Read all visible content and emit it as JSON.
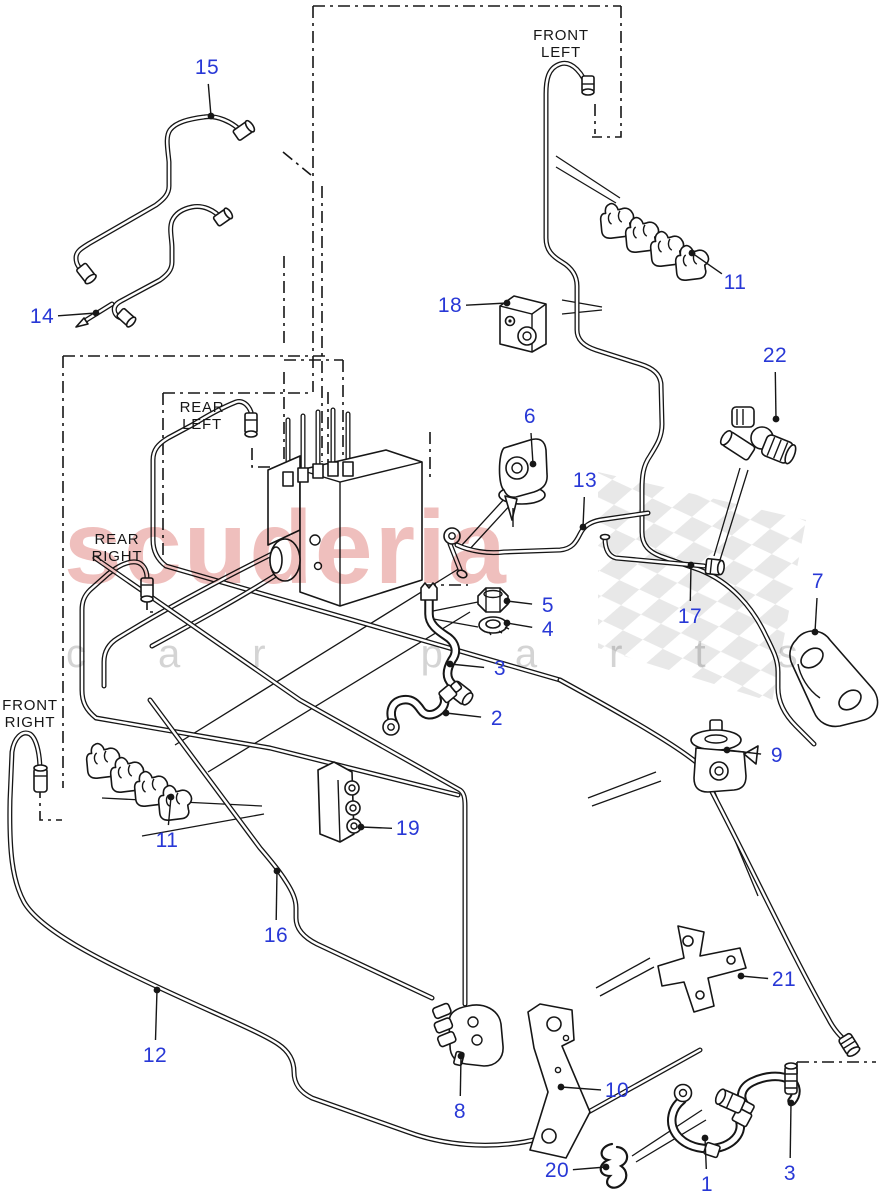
{
  "watermark": {
    "brand": "scuderia",
    "sub": "car parts",
    "brand_color": "#e0807b",
    "sub_color": "#c9c9c9"
  },
  "colors": {
    "callout": "#2838d6",
    "line": "#161616",
    "flag": "#d9d9d9"
  },
  "corner_labels": [
    {
      "id": "front-left",
      "line1": "FRONT",
      "line2": "LEFT",
      "x": 561,
      "y": 44
    },
    {
      "id": "rear-left",
      "line1": "REAR",
      "line2": "LEFT",
      "x": 202,
      "y": 416
    },
    {
      "id": "rear-right",
      "line1": "REAR",
      "line2": "RIGHT",
      "x": 117,
      "y": 548
    },
    {
      "id": "front-right",
      "line1": "FRONT",
      "line2": "RIGHT",
      "x": 30,
      "y": 714
    }
  ],
  "callouts": [
    {
      "id": "15",
      "label": "15",
      "x": 207,
      "y": 68,
      "dot": [
        211,
        116
      ]
    },
    {
      "id": "14",
      "label": "14",
      "x": 42,
      "y": 317,
      "dot": [
        96,
        313
      ]
    },
    {
      "id": "11-top",
      "label": "11",
      "x": 735,
      "y": 283,
      "dot": [
        692,
        253
      ]
    },
    {
      "id": "18",
      "label": "18",
      "x": 450,
      "y": 306,
      "dot": [
        507,
        303
      ]
    },
    {
      "id": "22",
      "label": "22",
      "x": 775,
      "y": 356,
      "dot": [
        776,
        419
      ]
    },
    {
      "id": "6",
      "label": "6",
      "x": 530,
      "y": 417,
      "dot": [
        533,
        464
      ]
    },
    {
      "id": "13",
      "label": "13",
      "x": 585,
      "y": 481,
      "dot": [
        583,
        527
      ]
    },
    {
      "id": "5",
      "label": "5",
      "x": 548,
      "y": 606,
      "dot": [
        507,
        601
      ]
    },
    {
      "id": "4",
      "label": "4",
      "x": 548,
      "y": 630,
      "dot": [
        507,
        623
      ]
    },
    {
      "id": "3-mid",
      "label": "3",
      "x": 500,
      "y": 669,
      "dot": [
        450,
        664
      ]
    },
    {
      "id": "2",
      "label": "2",
      "x": 497,
      "y": 719,
      "dot": [
        446,
        713
      ]
    },
    {
      "id": "17",
      "label": "17",
      "x": 690,
      "y": 617,
      "dot": [
        691,
        565
      ]
    },
    {
      "id": "7",
      "label": "7",
      "x": 818,
      "y": 582,
      "dot": [
        815,
        632
      ]
    },
    {
      "id": "11-left",
      "label": "11",
      "x": 167,
      "y": 841,
      "dot": [
        171,
        797
      ]
    },
    {
      "id": "19",
      "label": "19",
      "x": 408,
      "y": 829,
      "dot": [
        361,
        827
      ]
    },
    {
      "id": "9",
      "label": "9",
      "x": 777,
      "y": 756,
      "dot": [
        727,
        750
      ]
    },
    {
      "id": "16",
      "label": "16",
      "x": 276,
      "y": 936,
      "dot": [
        277,
        871
      ]
    },
    {
      "id": "21",
      "label": "21",
      "x": 784,
      "y": 980,
      "dot": [
        741,
        976
      ]
    },
    {
      "id": "12",
      "label": "12",
      "x": 155,
      "y": 1056,
      "dot": [
        157,
        990
      ]
    },
    {
      "id": "8",
      "label": "8",
      "x": 460,
      "y": 1112,
      "dot": [
        461,
        1056
      ]
    },
    {
      "id": "10",
      "label": "10",
      "x": 617,
      "y": 1091,
      "dot": [
        561,
        1087
      ]
    },
    {
      "id": "20",
      "label": "20",
      "x": 557,
      "y": 1171,
      "dot": [
        606,
        1167
      ]
    },
    {
      "id": "1",
      "label": "1",
      "x": 707,
      "y": 1185,
      "dot": [
        705,
        1138
      ]
    },
    {
      "id": "3-bottom",
      "label": "3",
      "x": 790,
      "y": 1174,
      "dot": [
        791,
        1103
      ]
    }
  ]
}
